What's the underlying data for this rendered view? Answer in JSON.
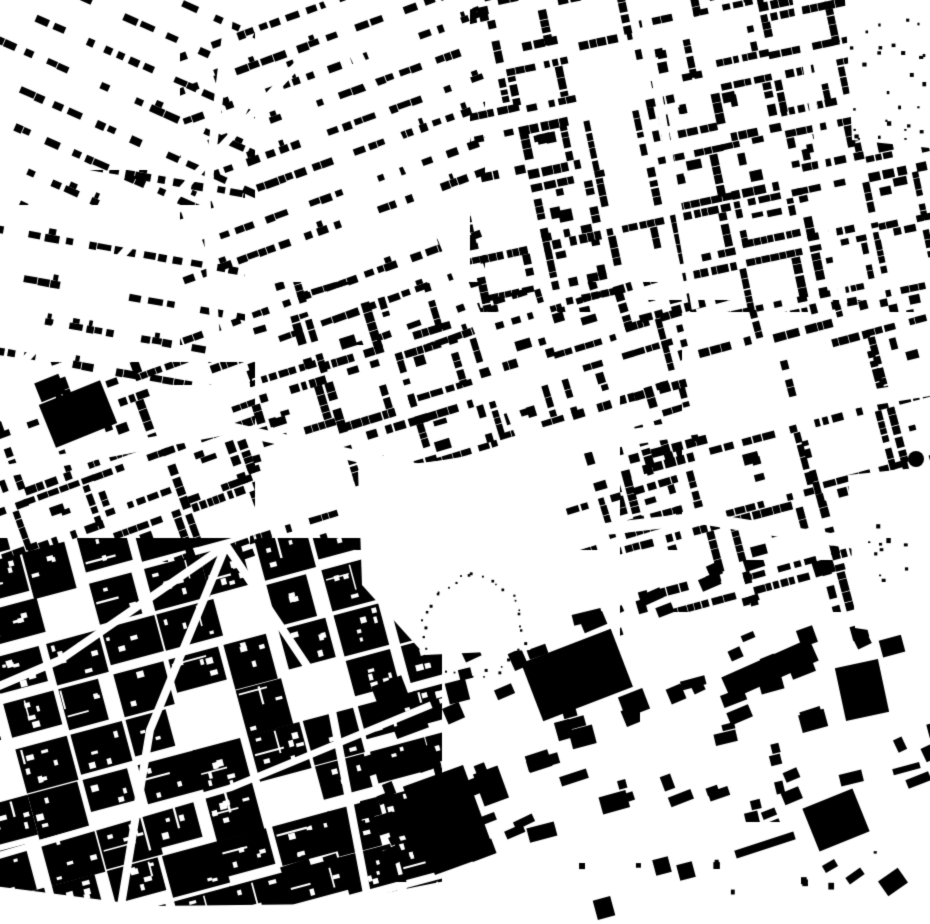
{
  "map": {
    "type": "figure-ground building footprint map (black buildings on white)",
    "width": 930,
    "height": 924,
    "background": "#ffffff",
    "ink": "#000000",
    "seed": 13,
    "districts": [
      {
        "name": "nw-outer",
        "rect": [
          0,
          0,
          255,
          205
        ],
        "angle": 24,
        "style": "rows",
        "params": {
          "spacing": 36,
          "len": [
            7,
            17
          ],
          "dep": [
            6,
            8
          ],
          "gapProb": 0.42,
          "rowSkip": 0.18,
          "scatter": 0.5
        }
      },
      {
        "name": "nw-inner",
        "rect": [
          0,
          170,
          245,
          215
        ],
        "angle": 10,
        "style": "rows",
        "params": {
          "spacing": 40,
          "len": [
            7,
            16
          ],
          "dep": [
            6,
            8
          ],
          "gapProb": 0.4,
          "rowSkip": 0.12,
          "scatter": 0.5,
          "crossEvery": 110,
          "crossGap": 9
        }
      },
      {
        "name": "west-mid",
        "rect": [
          0,
          362,
          255,
          200
        ],
        "angle": -20,
        "style": "perimeter",
        "params": {
          "bw": 64,
          "bh": 52,
          "sw": 10,
          "dep": [
            6,
            9
          ],
          "seg": [
            5,
            13
          ],
          "gapProb": 0.3,
          "edgeSkip": 0.22,
          "innerProb": 0.5,
          "cellSkip": 0.06
        }
      },
      {
        "name": "top-center",
        "rect": [
          180,
          0,
          305,
          345
        ],
        "angle": -20,
        "style": "rows",
        "params": {
          "spacing": 30,
          "len": [
            6,
            14
          ],
          "dep": [
            6,
            8
          ],
          "gapProb": 0.32,
          "rowSkip": 0.1,
          "scatter": 0.4,
          "crossEvery": 88,
          "crossGap": 8
        }
      },
      {
        "name": "north-east",
        "rect": [
          470,
          0,
          460,
          312
        ],
        "angle": -12,
        "style": "perimeter",
        "params": {
          "bw": 56,
          "bh": 50,
          "sw": 9,
          "dep": [
            6,
            9
          ],
          "seg": [
            5,
            12
          ],
          "gapProb": 0.26,
          "edgeSkip": 0.18,
          "innerProb": 0.45,
          "cellSkip": 0.07
        }
      },
      {
        "name": "center",
        "rect": [
          250,
          282,
          432,
          268
        ],
        "angle": -17,
        "style": "perimeter",
        "params": {
          "bw": 66,
          "bh": 56,
          "sw": 10,
          "dep": [
            6,
            9
          ],
          "seg": [
            5,
            13
          ],
          "gapProb": 0.28,
          "edgeSkip": 0.2,
          "innerProb": 0.5,
          "cellSkip": 0.06
        }
      },
      {
        "name": "east-mid",
        "rect": [
          620,
          300,
          310,
          312
        ],
        "angle": -15,
        "style": "perimeter",
        "params": {
          "bw": 80,
          "bh": 62,
          "sw": 11,
          "dep": [
            6,
            9
          ],
          "seg": [
            5,
            13
          ],
          "gapProb": 0.3,
          "edgeSkip": 0.22,
          "innerProb": 0.35,
          "cellSkip": 0.08
        }
      },
      {
        "name": "old-town",
        "rect": [
          0,
          538,
          442,
          386
        ],
        "angle": -15,
        "style": "dense",
        "params": {
          "bw": 50,
          "bh": 40,
          "sw": 7,
          "cellSkip": 0.08,
          "pores": [
            2,
            6
          ]
        }
      },
      {
        "name": "south-center",
        "rect": [
          360,
          580,
          280,
          302
        ],
        "angle": -20,
        "style": "scatterLarge",
        "params": {
          "count": 48,
          "w": [
            10,
            34
          ],
          "h": [
            8,
            22
          ],
          "jitter": 6,
          "lProb": 0.25
        }
      },
      {
        "name": "south-east",
        "rect": [
          620,
          560,
          310,
          262
        ],
        "angle": -20,
        "style": "scatterLarge",
        "params": {
          "count": 55,
          "w": [
            8,
            28
          ],
          "h": [
            6,
            18
          ],
          "jitter": 7,
          "lProb": 0.2
        }
      }
    ],
    "boulevards": [
      {
        "name": "main-diagonal-north",
        "pts": [
          [
            325,
            -10
          ],
          [
            445,
            240
          ],
          [
            530,
            455
          ]
        ],
        "w": 13
      },
      {
        "name": "east-boulevard-upper",
        "pts": [
          [
            420,
            472
          ],
          [
            930,
            388
          ]
        ],
        "w": 16
      },
      {
        "name": "east-boulevard-lower",
        "pts": [
          [
            468,
            545
          ],
          [
            700,
            518
          ],
          [
            935,
            556
          ]
        ],
        "w": 12
      },
      {
        "name": "west-boulevard",
        "pts": [
          [
            -10,
            474
          ],
          [
            230,
            428
          ],
          [
            420,
            470
          ]
        ],
        "w": 12
      },
      {
        "name": "nw-vertical-street",
        "pts": [
          [
            232,
            -10
          ],
          [
            206,
            200
          ],
          [
            216,
            345
          ]
        ],
        "w": 9
      },
      {
        "name": "nw-diagonal-street",
        "pts": [
          [
            -10,
            398
          ],
          [
            300,
            62
          ]
        ],
        "w": 8
      },
      {
        "name": "oldtown-fan-east",
        "pts": [
          [
            228,
            548
          ],
          [
            330,
            700
          ],
          [
            372,
            920
          ]
        ],
        "w": 8
      },
      {
        "name": "oldtown-fan-mid",
        "pts": [
          [
            225,
            548
          ],
          [
            150,
            730
          ],
          [
            118,
            924
          ]
        ],
        "w": 8
      },
      {
        "name": "oldtown-fan-west",
        "pts": [
          [
            222,
            548
          ],
          [
            60,
            660
          ],
          [
            -10,
            690
          ]
        ],
        "w": 8
      },
      {
        "name": "oldtown-cross",
        "pts": [
          [
            -10,
            858
          ],
          [
            230,
            788
          ],
          [
            428,
            706
          ]
        ],
        "w": 7
      },
      {
        "name": "ne-vertical-1",
        "pts": [
          [
            640,
            -10
          ],
          [
            695,
            305
          ]
        ],
        "w": 8
      },
      {
        "name": "ne-vertical-2",
        "pts": [
          [
            795,
            -10
          ],
          [
            843,
            300
          ]
        ],
        "w": 8
      }
    ],
    "plazas": [
      {
        "name": "central-plaza",
        "pts": [
          [
            358,
            470
          ],
          [
            552,
            448
          ],
          [
            575,
            555
          ],
          [
            530,
            650
          ],
          [
            425,
            655
          ],
          [
            362,
            585
          ]
        ]
      },
      {
        "name": "east-open-ground",
        "pts": [
          [
            848,
            475
          ],
          [
            935,
            466
          ],
          [
            935,
            640
          ],
          [
            855,
            628
          ]
        ]
      },
      {
        "name": "ne-corner-clearing",
        "pts": [
          [
            845,
            0
          ],
          [
            930,
            0
          ],
          [
            930,
            148
          ],
          [
            852,
            140
          ]
        ]
      },
      {
        "name": "south-open-strip",
        "pts": [
          [
            -5,
            886
          ],
          [
            150,
            906
          ],
          [
            330,
            904
          ],
          [
            560,
            858
          ],
          [
            935,
            826
          ],
          [
            935,
            924
          ],
          [
            -5,
            924
          ]
        ]
      }
    ],
    "extras": [
      {
        "t": "circle",
        "name": "gasometer-circle",
        "cx": 916,
        "cy": 459,
        "r": 8
      },
      {
        "t": "rect",
        "name": "large-hall-south",
        "cx": 449,
        "cy": 820,
        "w": 64,
        "h": 94,
        "rot": -20
      },
      {
        "t": "rect",
        "name": "large-hall-south-annex",
        "cx": 491,
        "cy": 786,
        "w": 26,
        "h": 34,
        "rot": -20
      },
      {
        "t": "rect",
        "name": "large-hall-south-annex2",
        "cx": 427,
        "cy": 758,
        "w": 22,
        "h": 24,
        "rot": -20
      },
      {
        "t": "rect",
        "name": "large-block-center-south",
        "cx": 577,
        "cy": 675,
        "w": 96,
        "h": 62,
        "rot": -21
      },
      {
        "t": "rect",
        "name": "large-block-annex",
        "cx": 634,
        "cy": 703,
        "w": 26,
        "h": 22,
        "rot": -21
      },
      {
        "t": "rect",
        "name": "long-bar-southeast",
        "cx": 770,
        "cy": 669,
        "w": 96,
        "h": 24,
        "rot": -24
      },
      {
        "t": "rect",
        "name": "west-solid-block",
        "cx": 78,
        "cy": 414,
        "w": 66,
        "h": 46,
        "rot": -22
      },
      {
        "t": "rect",
        "name": "west-solid-annex",
        "cx": 50,
        "cy": 388,
        "w": 26,
        "h": 20,
        "rot": -22
      },
      {
        "t": "rect",
        "name": "se-cluster-block",
        "cx": 836,
        "cy": 820,
        "w": 54,
        "h": 46,
        "rot": -22
      },
      {
        "t": "rect",
        "name": "se-tall-block",
        "cx": 862,
        "cy": 690,
        "w": 44,
        "h": 54,
        "rot": -12
      },
      {
        "t": "rect",
        "name": "se-thin-bar",
        "cx": 765,
        "cy": 845,
        "w": 62,
        "h": 8,
        "rot": -18
      },
      {
        "t": "rect",
        "name": "square-pair-a",
        "cx": 662,
        "cy": 866,
        "w": 16,
        "h": 16,
        "rot": -15
      },
      {
        "t": "rect",
        "name": "square-pair-b",
        "cx": 686,
        "cy": 871,
        "w": 16,
        "h": 16,
        "rot": -15
      },
      {
        "t": "rect",
        "name": "lone-south-block",
        "cx": 604,
        "cy": 908,
        "w": 18,
        "h": 20,
        "rot": -15
      },
      {
        "t": "rect",
        "name": "bottom-bar-a",
        "cx": 296,
        "cy": 868,
        "w": 30,
        "h": 11,
        "rot": -18
      },
      {
        "t": "rect",
        "name": "bottom-bar-b",
        "cx": 331,
        "cy": 861,
        "w": 14,
        "h": 12,
        "rot": -18
      },
      {
        "t": "rect",
        "name": "se-wedge",
        "cx": 893,
        "cy": 882,
        "w": 24,
        "h": 18,
        "rot": -35
      },
      {
        "t": "rect",
        "name": "se-arc-bar-a",
        "cx": 855,
        "cy": 876,
        "w": 18,
        "h": 8,
        "rot": -35
      },
      {
        "t": "rect",
        "name": "se-arc-bar-b",
        "cx": 830,
        "cy": 866,
        "w": 14,
        "h": 8,
        "rot": -30
      },
      {
        "t": "stipple",
        "name": "plaza-tree-ring",
        "n": 13,
        "jitter": 4,
        "smin": 1.5,
        "smax": 3,
        "segs": [
          [
            [
              425,
              660
            ],
            [
              412,
              588
            ],
            [
              470,
              574
            ]
          ],
          [
            [
              470,
              574
            ],
            [
              535,
              585
            ],
            [
              518,
              652
            ]
          ],
          [
            [
              518,
              652
            ],
            [
              472,
              692
            ],
            [
              425,
              660
            ]
          ]
        ]
      },
      {
        "t": "dots",
        "name": "ne-corner-dots",
        "rect": [
          848,
          6,
          78,
          138
        ],
        "n": 28,
        "smin": 2,
        "smax": 4.5
      },
      {
        "t": "dots",
        "name": "east-open-dots",
        "rect": [
          858,
          484,
          66,
          132
        ],
        "n": 10,
        "smin": 2,
        "smax": 5
      },
      {
        "t": "dots",
        "name": "south-strip-dots",
        "rect": [
          566,
          850,
          340,
          62
        ],
        "n": 9,
        "smin": 3,
        "smax": 7
      }
    ]
  }
}
